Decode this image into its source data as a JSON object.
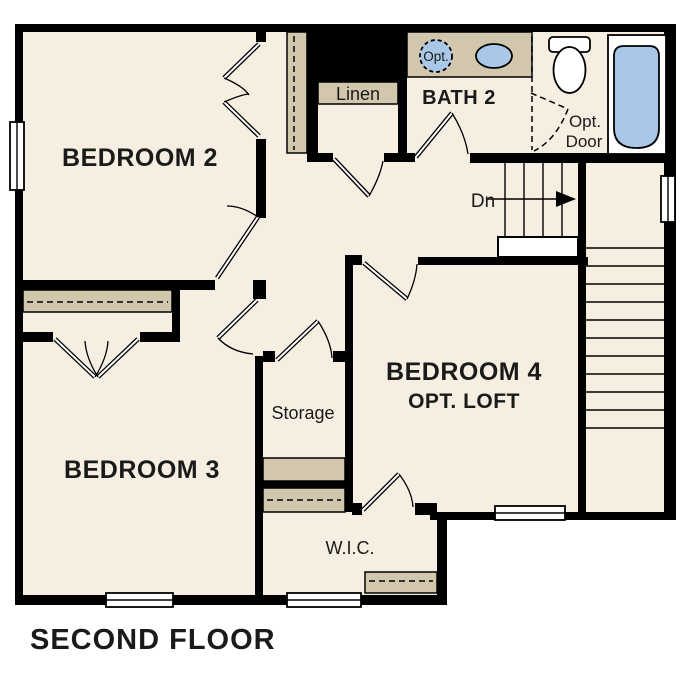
{
  "page_title": "SECOND FLOOR",
  "colors": {
    "floor": "#f5eee1",
    "cabinet": "#d2c6ad",
    "fixture": "#a9c8e8",
    "wall": "#000000",
    "text": "#1a1a1a",
    "page": "#ffffff"
  },
  "rooms": {
    "bedroom2": {
      "label": "BEDROOM 2"
    },
    "bedroom3": {
      "label": "BEDROOM 3"
    },
    "bedroom4": {
      "label": "BEDROOM 4",
      "sublabel": "OPT. LOFT"
    },
    "bath2": {
      "label": "BATH 2"
    },
    "linen": {
      "label": "Linen"
    },
    "storage": {
      "label": "Storage"
    },
    "wic": {
      "label": "W.I.C."
    }
  },
  "annotations": {
    "opt_sink_label": "Opt.",
    "opt_door_line1": "Opt.",
    "opt_door_line2": "Door",
    "stairs_down_label": "Dn"
  }
}
